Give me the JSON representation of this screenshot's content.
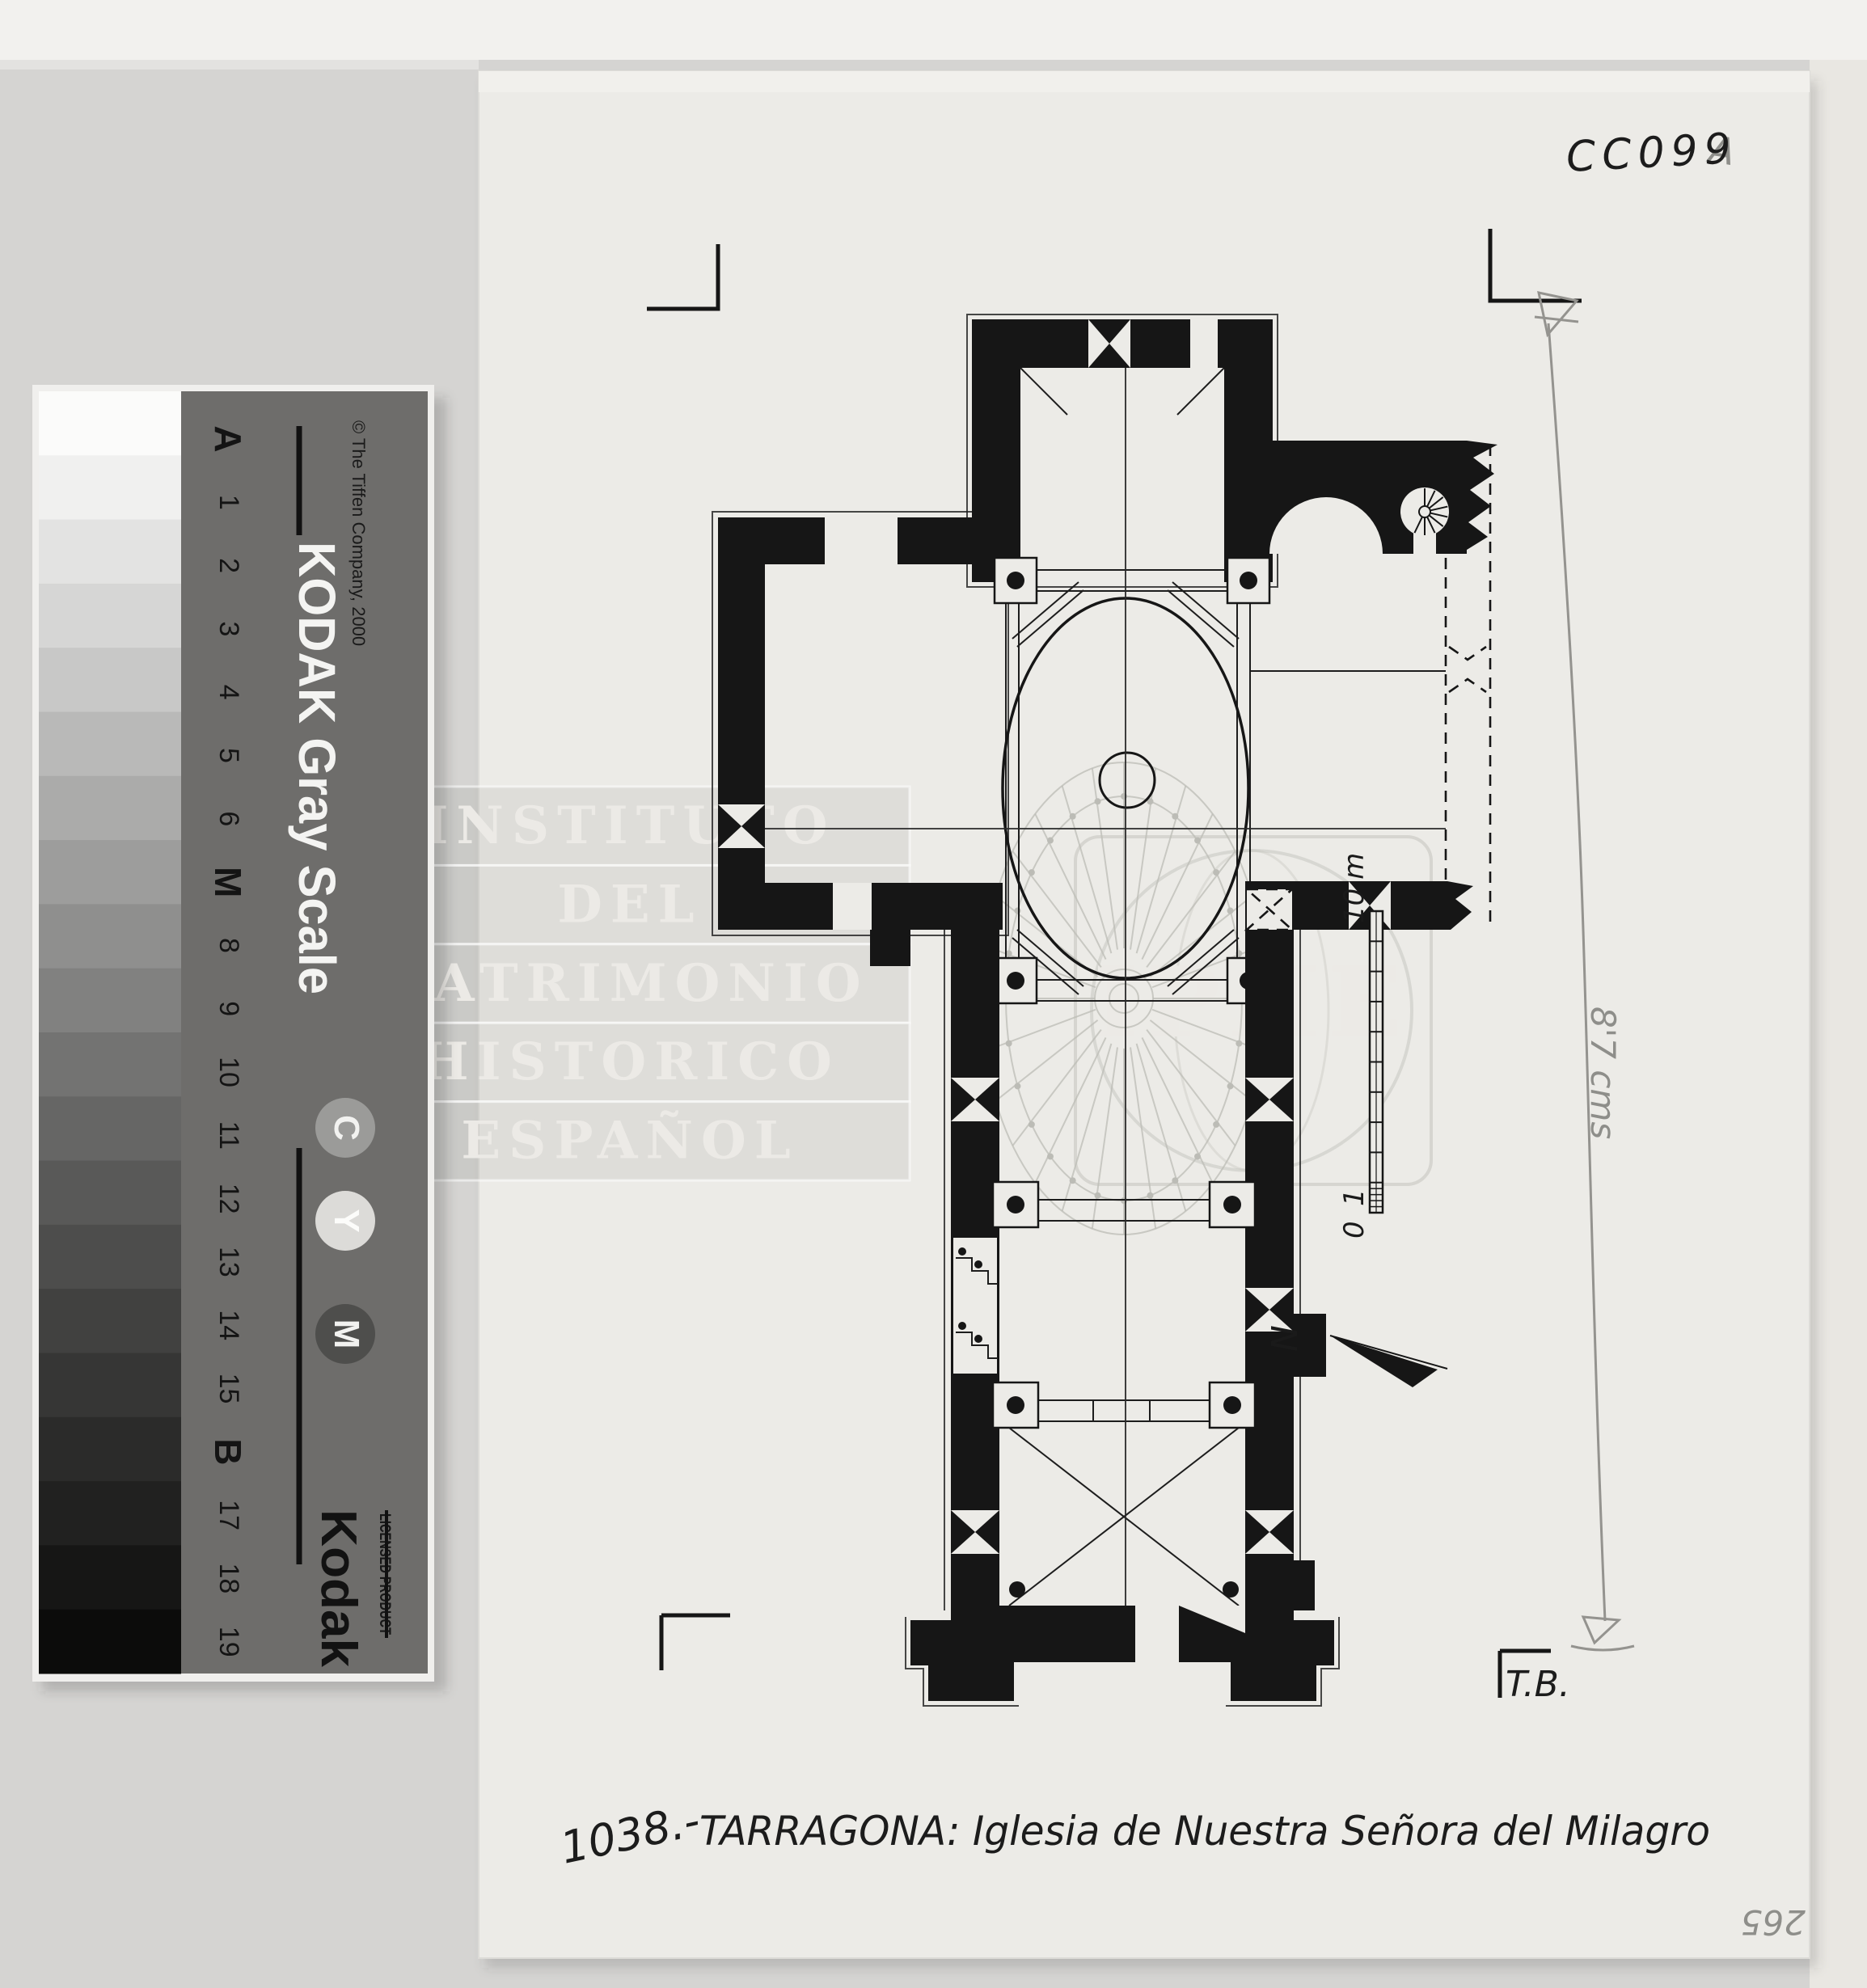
{
  "archive": {
    "code": "CC099",
    "suffix": "A",
    "page_number": "265",
    "pencil_note": "8'7 cms",
    "initials": "T.B."
  },
  "caption": {
    "number": "1038.-",
    "title": "TARRAGONA: Iglesia de Nuestra Señora del Milagro"
  },
  "plan": {
    "north_label": "N",
    "scale": {
      "zero": "0",
      "one": "1",
      "ten_m": "10 m"
    }
  },
  "watermark": {
    "lines": [
      "INSTITUTO",
      "DEL",
      "PATRIMONIO",
      "HISTORICO",
      "ESPAÑOL"
    ],
    "acronym": "IPHE"
  },
  "ruler": {
    "title": "KODAK Gray Scale",
    "copyright": "© The Tiffen Company, 2000",
    "brand": "Kodak",
    "brand_subtitle": "LICENSED PRODUCT",
    "cym": [
      "C",
      "Y",
      "M"
    ],
    "steps": [
      "A",
      "1",
      "2",
      "3",
      "4",
      "5",
      "6",
      "M",
      "8",
      "9",
      "10",
      "11",
      "12",
      "13",
      "14",
      "15",
      "B",
      "17",
      "18",
      "19"
    ],
    "patch_colors": [
      "#fbfbfa",
      "#f0f0ef",
      "#e3e3e2",
      "#d6d6d5",
      "#c8c8c7",
      "#b9b9b8",
      "#ababaa",
      "#9d9d9c",
      "#8f8f8e",
      "#818180",
      "#737372",
      "#666665",
      "#595958",
      "#4d4d4c",
      "#414140",
      "#363635",
      "#2b2b2a",
      "#212120",
      "#161615",
      "#0c0c0b"
    ]
  },
  "colors": {
    "paper": "#ecebe7",
    "background": "#d5d4d2",
    "ink": "#161616",
    "pencil": "#8e8e8a",
    "ruler_card": "#6e6d6b"
  }
}
